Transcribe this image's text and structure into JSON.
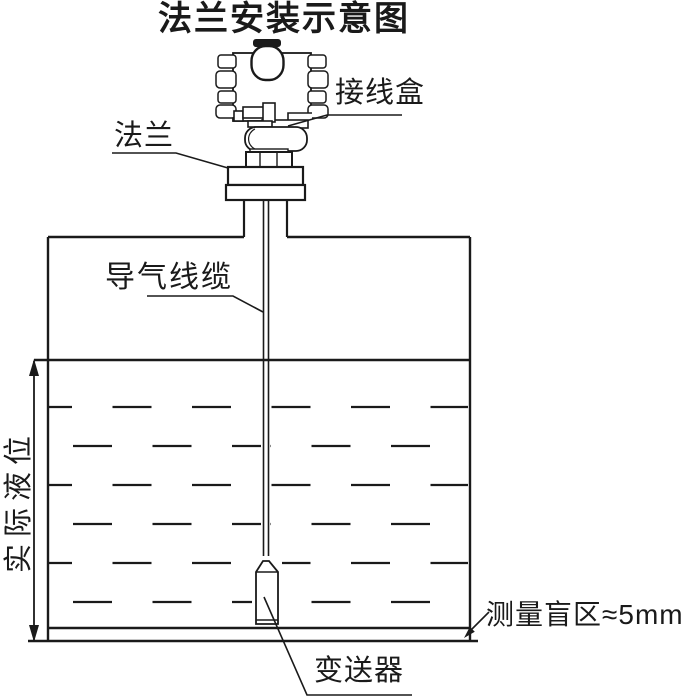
{
  "title": "法兰安装示意图",
  "labels": {
    "junction_box": "接线盒",
    "flange": "法兰",
    "air_cable": "导气线缆",
    "actual_level": "实际液位",
    "blind_zone": "测量盲区≈5mm",
    "transmitter": "变送器"
  },
  "colors": {
    "line": "#1a1a1a",
    "background": "#ffffff"
  }
}
